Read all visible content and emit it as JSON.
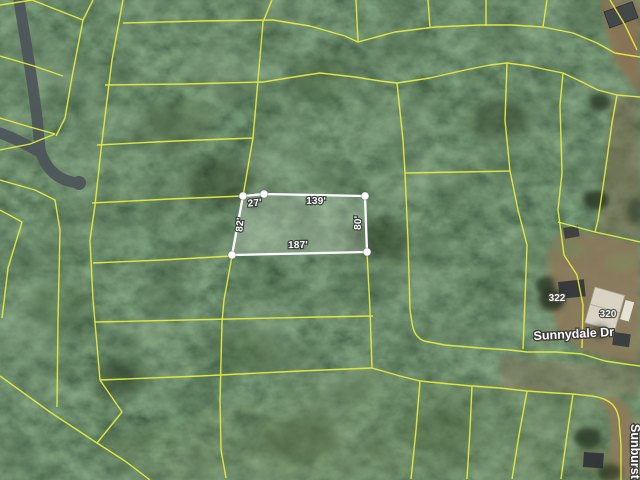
{
  "view": {
    "kind": "aerial-parcel-map",
    "width": 640,
    "height": 480
  },
  "selected_parcel": {
    "dimension_labels": {
      "top_short": "27'",
      "top": "139'",
      "right": "80'",
      "bottom": "187'",
      "left": "82'"
    }
  },
  "labels": {
    "street_main": "Sunnydale Dr",
    "street_side": "Sunburst",
    "address_1": "322",
    "address_2": "320"
  },
  "colors": {
    "parcel_boundary": "#e5ec3e",
    "selection_outline": "#ffffff",
    "road_gray": "#4d555a",
    "dirt": "#8d7a5c"
  }
}
